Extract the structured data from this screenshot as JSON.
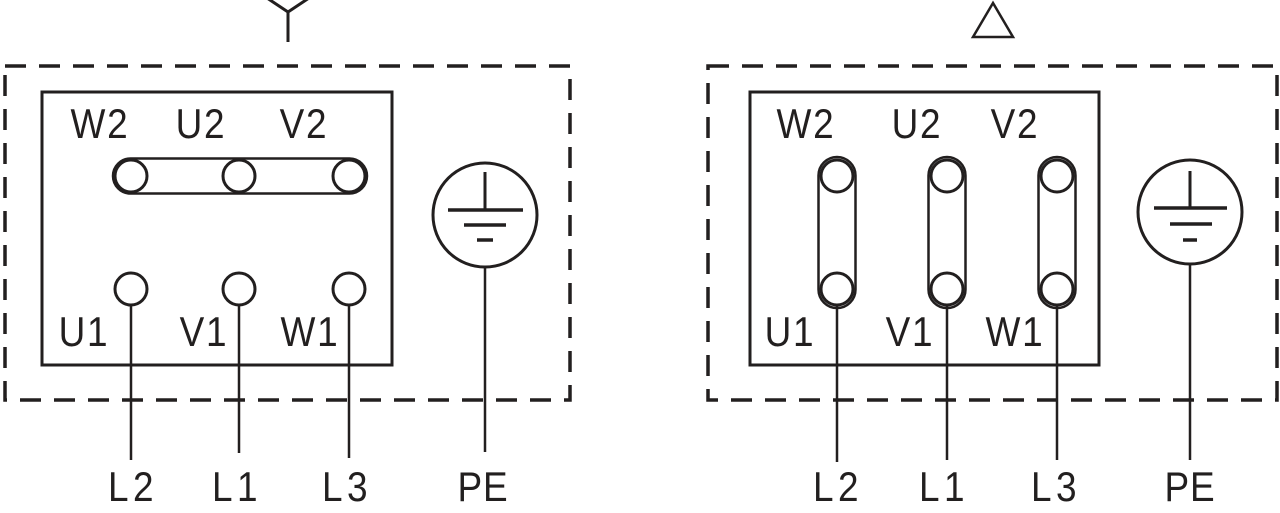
{
  "figure": {
    "background_color": "#ffffff",
    "line_color": "#221f1f"
  },
  "left_diagram": {
    "connection": "star",
    "symbol_icon": "star-icon",
    "top_terminals": [
      "W2",
      "U2",
      "V2"
    ],
    "bottom_terminals": [
      "U1",
      "V1",
      "W1"
    ],
    "supply_lines": [
      "L2",
      "L1",
      "L3"
    ],
    "earth_label": "PE"
  },
  "right_diagram": {
    "connection": "delta",
    "symbol_icon": "delta-icon",
    "top_terminals": [
      "W2",
      "U2",
      "V2"
    ],
    "bottom_terminals": [
      "U1",
      "V1",
      "W1"
    ],
    "supply_lines": [
      "L2",
      "L1",
      "L3"
    ],
    "earth_label": "PE"
  }
}
